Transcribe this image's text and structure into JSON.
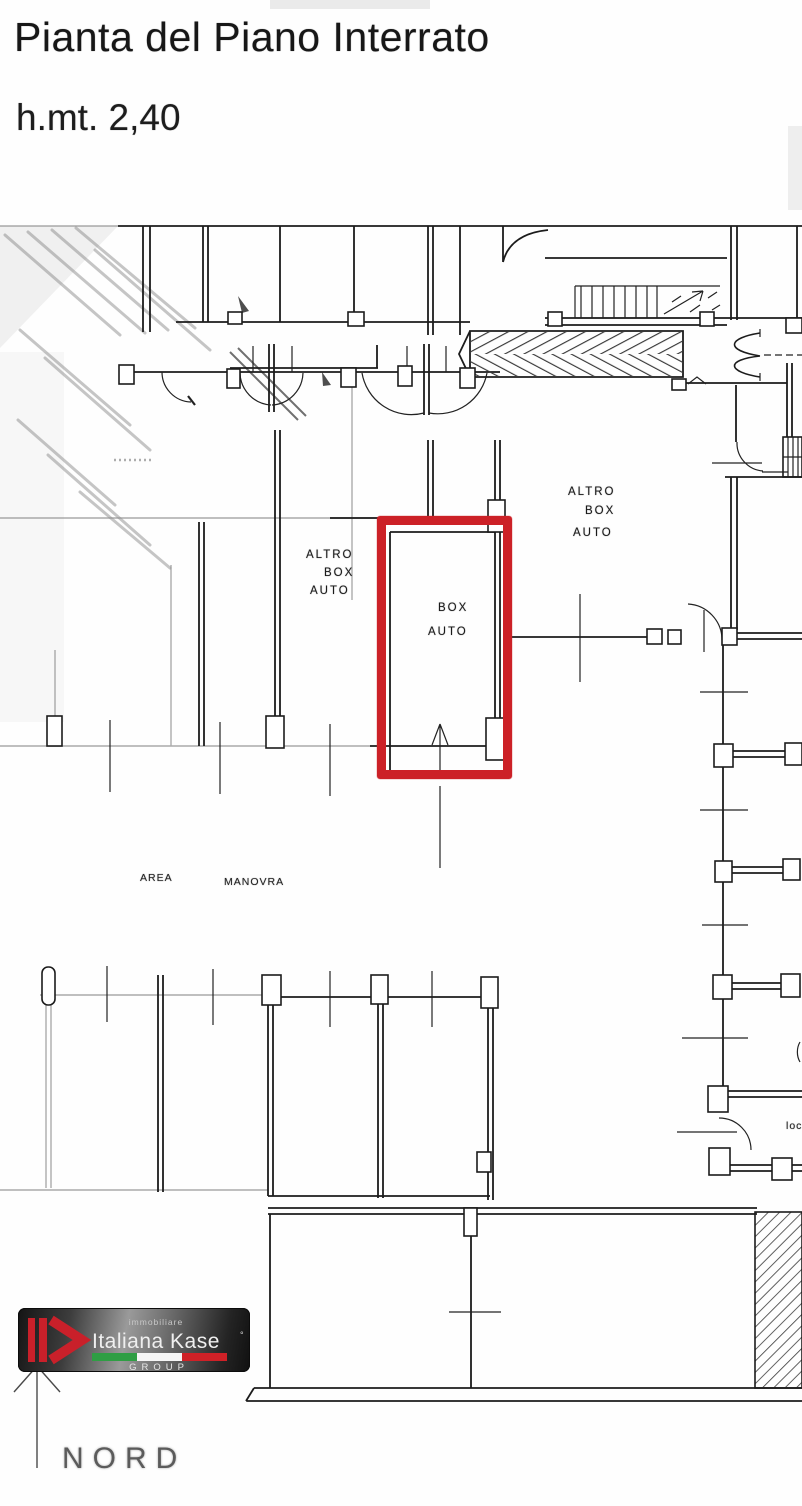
{
  "header": {
    "title": "Pianta del Piano Interrato",
    "subtitle": "h.mt. 2,40"
  },
  "plan": {
    "labels": {
      "altro_box_left": [
        "ALTRO",
        "BOX",
        "AUTO"
      ],
      "box_selected": [
        "BOX",
        "AUTO"
      ],
      "altro_box_right": [
        "ALTRO",
        "BOX",
        "AUTO"
      ],
      "area_manovra": [
        "AREA",
        "MANOVRA"
      ],
      "loc_partial": "loc"
    },
    "highlight_color": "#cc2127"
  },
  "branding": {
    "prefix": "immobiliare",
    "agency_name": "Italiana Kase",
    "registered_mark": "°",
    "group_label": "GROUP",
    "logo_red": "#c9202a",
    "flag_colors": [
      "#2f9e44",
      "#f5f5f5",
      "#cf2127"
    ]
  },
  "compass": {
    "north_label": "NORD"
  }
}
